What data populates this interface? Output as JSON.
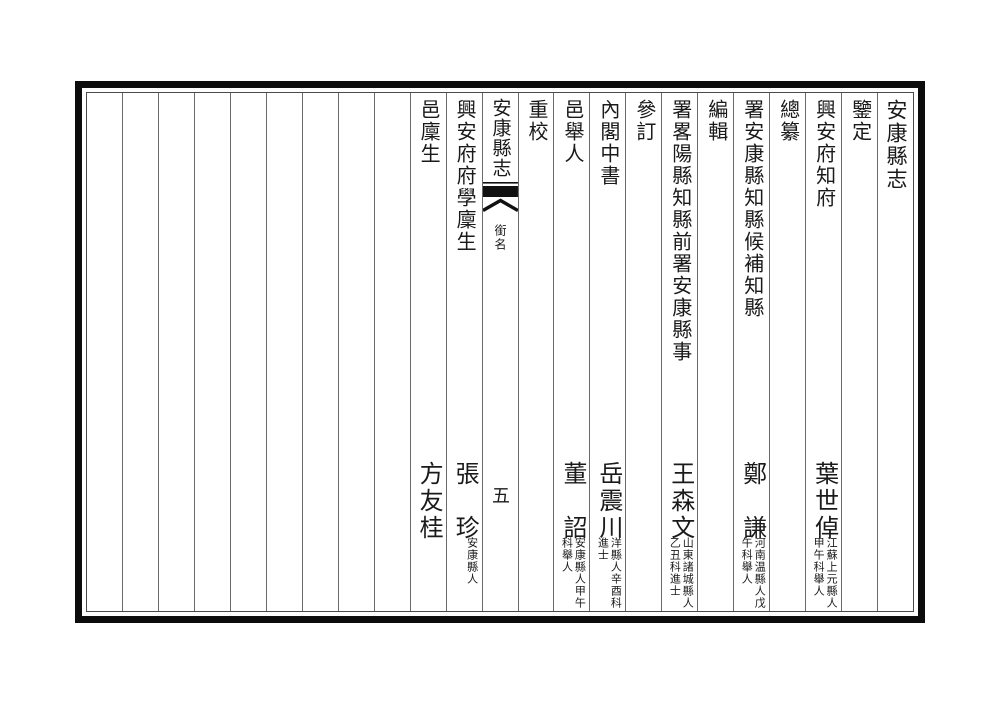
{
  "book": {
    "title": "安康縣志"
  },
  "colors": {
    "background": "#ffffff",
    "text": "#1a1a1a",
    "outer_border": "#0c0c0c",
    "inner_border": "#4a4a4a",
    "column_divider": "#6a6a6a",
    "fishtail": "#111111"
  },
  "fold": {
    "title": "安康縣志",
    "fishtail_icon": "fishtail-marker",
    "section": "銜名",
    "page_number": "五"
  },
  "columns": [
    {
      "header": "安康縣志"
    },
    {
      "header": "鑒定"
    },
    {
      "header": "興安府知府",
      "name": "葉世倬",
      "annotation": [
        "江蘇上元縣人",
        "甲午科舉人"
      ]
    },
    {
      "header": "總纂"
    },
    {
      "header": "署安康縣知縣候補知縣",
      "name": "鄭　謙",
      "annotation": [
        "河南温縣人戊",
        "午科舉人"
      ]
    },
    {
      "header": "編輯"
    },
    {
      "header": "署畧陽縣知縣前署安康縣事",
      "name": "王森文",
      "annotation": [
        "山東諸城縣人",
        "乙丑科進士"
      ]
    },
    {
      "header": "參訂"
    },
    {
      "header": "內閣中書",
      "name": "岳震川",
      "annotation": [
        "洋縣人辛酉科",
        "進士"
      ]
    },
    {
      "header": "邑舉人",
      "name": "董　詔",
      "annotation": [
        "安康縣人甲午",
        "科舉人"
      ]
    },
    {
      "header": "重校"
    },
    {
      "header": "興安府府學廩生",
      "name": "張　珍",
      "annotation": [
        "安康縣人"
      ]
    },
    {
      "header": "邑廩生",
      "name": "方友桂"
    }
  ],
  "empty_column_count": 9
}
